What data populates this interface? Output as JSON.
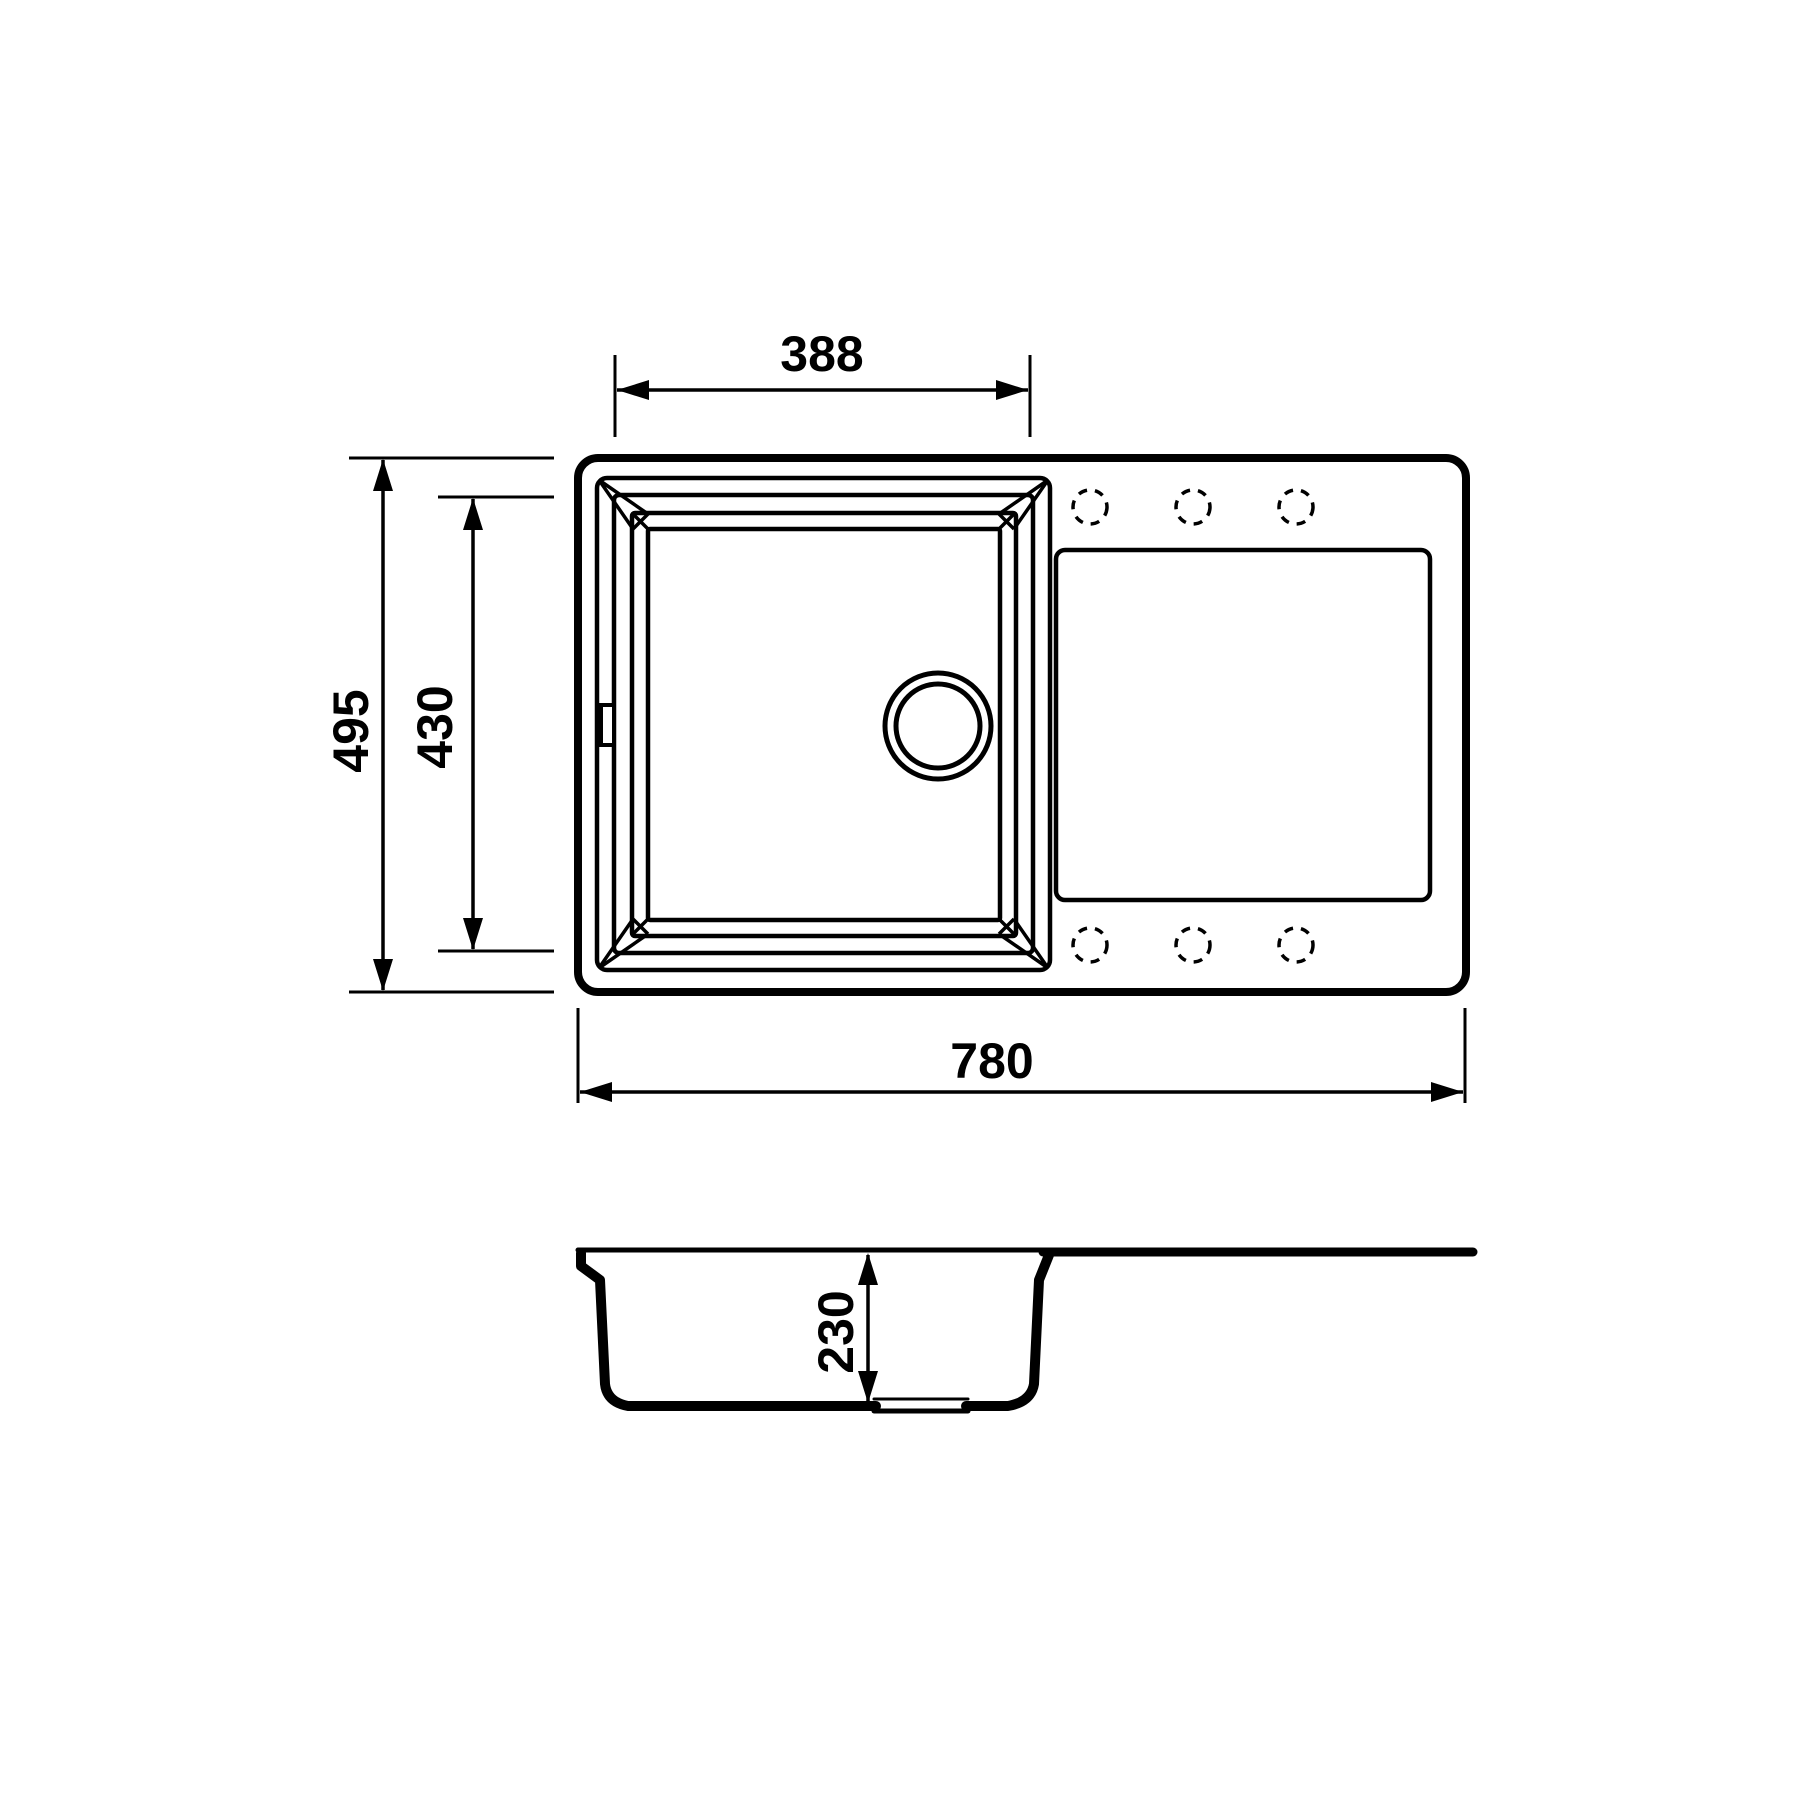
{
  "drawing": {
    "kind": "kitchen-sink-technical-drawing",
    "colors": {
      "line": "#000000",
      "background": "#ffffff"
    },
    "dimensions": {
      "basin_width": "388",
      "overall_depth": "495",
      "basin_depth": "430",
      "overall_width": "780",
      "basin_height": "230"
    },
    "features": {
      "faucet_holes": 6,
      "drain": "circular drain in basin",
      "views": [
        "top view",
        "side section view"
      ]
    }
  }
}
